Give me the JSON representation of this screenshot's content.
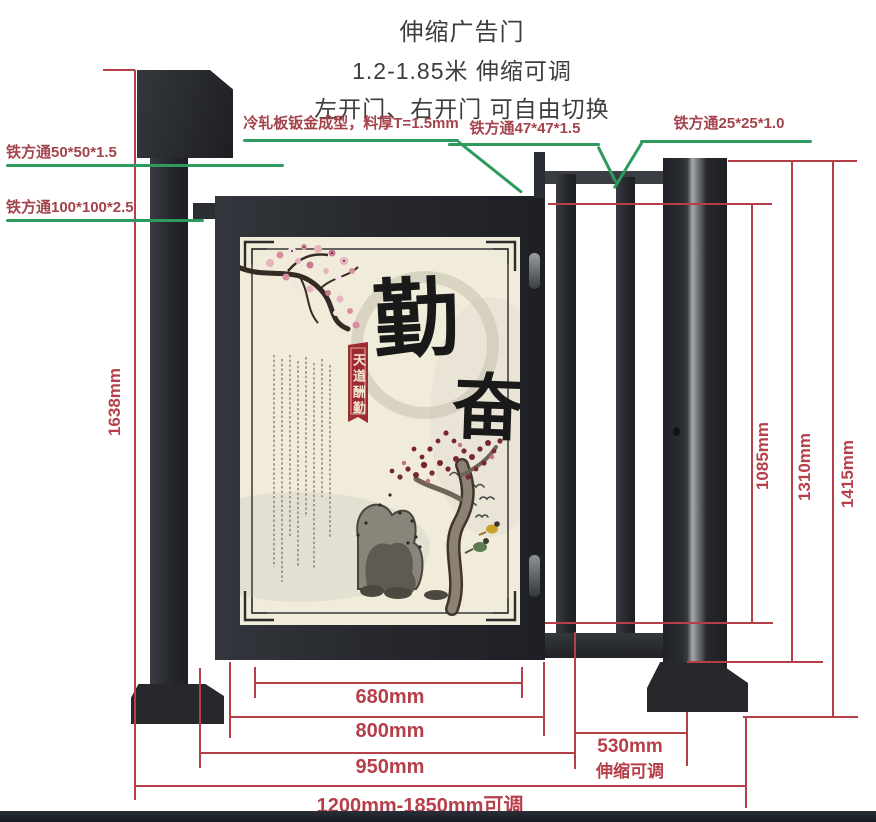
{
  "title": {
    "line1": "伸缩广告门",
    "line2": "1.2-1.85米 伸缩可调",
    "line3": "左开门、右开门 可自由切换"
  },
  "callout_labels": {
    "cold_rolled_sheet": "冷轧板钣金成型，料厚T=1.5mm",
    "tube_47": "铁方通47*47*1.5",
    "tube_25": "铁方通25*25*1.0",
    "tube_50": "铁方通50*50*1.5",
    "tube_100": "铁方通100*100*2.5"
  },
  "dimensions": {
    "total_height": "1638mm",
    "fence_inner_height": "1085mm",
    "fence_height": "1310mm",
    "post_height": "1415mm",
    "ad_panel_width": "680mm",
    "door_width": "800mm",
    "door_section_width": "950mm",
    "telescopic_width": "530mm",
    "telescopic_note": "伸缩可调",
    "total_width_range": "1200mm-1850mm可调"
  },
  "ad_panel": {
    "calligraphy_top": "勤",
    "calligraphy_bottom": "奋",
    "banner_text": "天道酬勤"
  },
  "colors": {
    "dimension_red": "#b5404a",
    "callout_green": "#2e9b5e",
    "metal_dark": "#26292e",
    "panel_cream": "#f1ebda",
    "banner_red": "#9d2b31"
  }
}
